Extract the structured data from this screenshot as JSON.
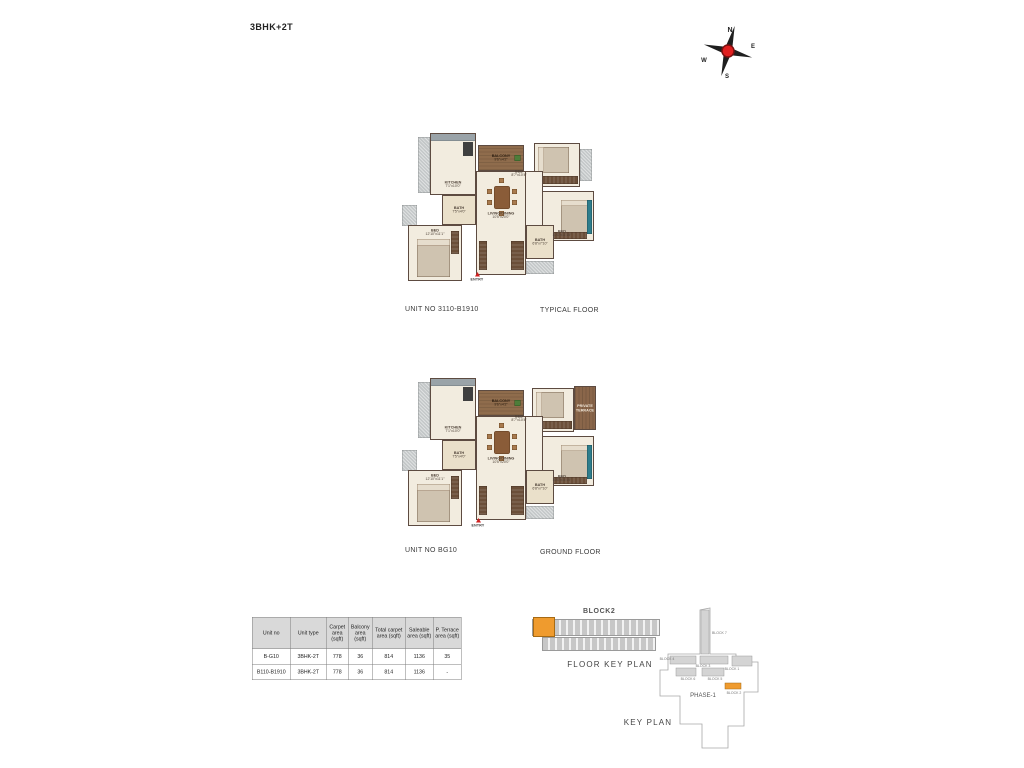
{
  "page": {
    "title": "3BHK+2T"
  },
  "compass": {
    "north": "N",
    "east": "E",
    "south": "S",
    "west": "W"
  },
  "plans": [
    {
      "unit_label": "UNIT NO  3110-B1910",
      "floor_label": "TYPICAL FLOOR",
      "entry_label": "ENTRY",
      "rooms": {
        "balcony": {
          "name": "BALCONY",
          "dims": "9'6\"x4'2\""
        },
        "kitchen": {
          "name": "KITCHEN",
          "dims": "7'1\"x10'0\""
        },
        "bath1": {
          "name": "BATH",
          "dims": "7'5\"x4'0\""
        },
        "living": {
          "name": "LIVING/DINING",
          "dims": "10'5\"x20'0\""
        },
        "bed1": {
          "name": "BED",
          "dims": "12'10\"x11'1\""
        },
        "bed2": {
          "name": "BED",
          "dims": "8'7\"x10'4\""
        },
        "bed3": {
          "name": "BED",
          "dims": "10'0\"x11'10\""
        },
        "bath2": {
          "name": "BATH",
          "dims": "6'8\"x7'10\""
        }
      }
    },
    {
      "unit_label": "UNIT NO  BG10",
      "floor_label": "GROUND FLOOR",
      "entry_label": "ENTRY",
      "rooms": {
        "balcony": {
          "name": "BALCONY",
          "dims": "9'6\"x4'2\""
        },
        "kitchen": {
          "name": "KITCHEN",
          "dims": "7'1\"x10'0\""
        },
        "bath1": {
          "name": "BATH",
          "dims": "7'5\"x4'0\""
        },
        "living": {
          "name": "LIVING/DINING",
          "dims": "10'5\"x20'0\""
        },
        "bed1": {
          "name": "BED",
          "dims": "12'10\"x11'1\""
        },
        "bed2": {
          "name": "BED",
          "dims": "8'7\"x10'4\""
        },
        "bed3": {
          "name": "BED",
          "dims": "10'0\"x11'10\""
        },
        "bath2": {
          "name": "BATH",
          "dims": "6'8\"x7'10\""
        },
        "terrace": {
          "name": "PRIVATE TERRACE",
          "dims": ""
        }
      }
    }
  ],
  "area_table": {
    "headers": [
      "Unit no",
      "Unit type",
      "Carpet area (sqft)",
      "Balcony area (sqft)",
      "Total carpet area (sqft)",
      "Saleable area (sqft)",
      "P. Terrace area (sqft)"
    ],
    "rows": [
      [
        "B-G10",
        "3BHK-2T",
        "778",
        "36",
        "814",
        "1136",
        "35"
      ],
      [
        "B110-B1910",
        "3BHK-2T",
        "778",
        "36",
        "814",
        "1136",
        "-"
      ]
    ]
  },
  "floor_key_plan": {
    "block_title": "BLOCK2",
    "caption": "FLOOR KEY PLAN"
  },
  "key_plan": {
    "caption": "KEY PLAN",
    "phase_label": "PHASE-1",
    "blocks": [
      "BLOCK 7",
      "BLOCK 4",
      "BLOCK 3",
      "BLOCK 1",
      "BLOCK 6",
      "BLOCK 5",
      "BLOCK 2"
    ]
  },
  "colors": {
    "highlight": "#ef9b2e",
    "wall": "#5d4b41",
    "floor": "#f2ecdf",
    "entry": "#cf2020"
  }
}
